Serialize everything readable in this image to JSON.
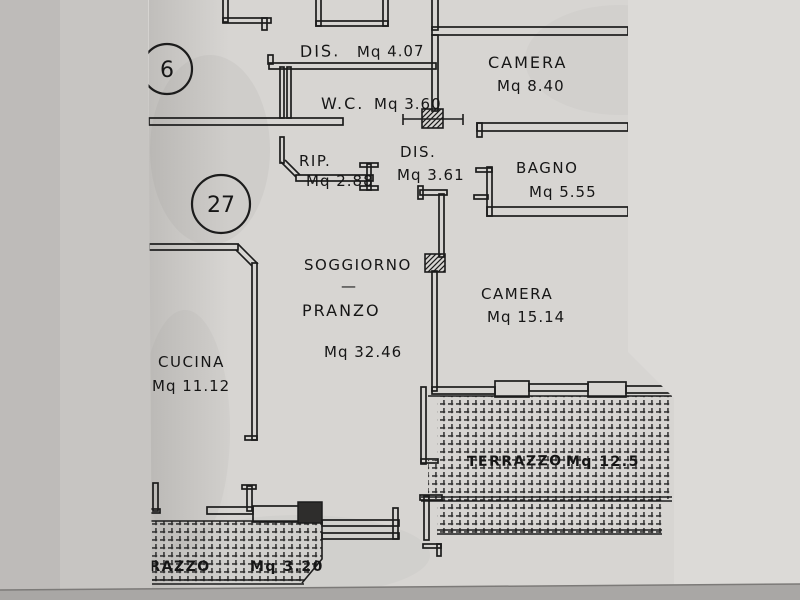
{
  "plan": {
    "markers": [
      {
        "number": "6"
      },
      {
        "number": "27"
      }
    ],
    "rooms": [
      {
        "id": "dis-top",
        "name": "DIS.",
        "area": "Mq 4.07"
      },
      {
        "id": "camera-top",
        "name": "CAMERA",
        "area": "Mq 8.40"
      },
      {
        "id": "wc",
        "name": "W.C.",
        "area": "Mq 3.60"
      },
      {
        "id": "rip",
        "name": "RIP.",
        "area": "Mq 2.88"
      },
      {
        "id": "dis-mid",
        "name": "DIS.",
        "area": "Mq 3.61"
      },
      {
        "id": "bagno",
        "name": "BAGNO",
        "area": "Mq 5.55"
      },
      {
        "id": "soggiorno-pranzo",
        "name": "SOGGIORNO",
        "separator": "—",
        "name2": "PRANZO",
        "area": "Mq 32.46"
      },
      {
        "id": "camera-main",
        "name": "CAMERA",
        "area": "Mq 15.14"
      },
      {
        "id": "cucina",
        "name": "CUCINA",
        "area": "Mq 11.12"
      },
      {
        "id": "terrazzo-large",
        "name": "TERRAZZO",
        "area": "Mq 12.5"
      },
      {
        "id": "terrazzo-small",
        "name": "TERRAZZO",
        "area": "Mq 3.20"
      }
    ],
    "colors": {
      "paper": "#d7d5d2",
      "ink": "#1c1c1c",
      "page_edge_left": "#c7c5c2",
      "page_edge_right": "#dcdad7",
      "photo_margin_bottom": "#a9a7a5"
    }
  }
}
